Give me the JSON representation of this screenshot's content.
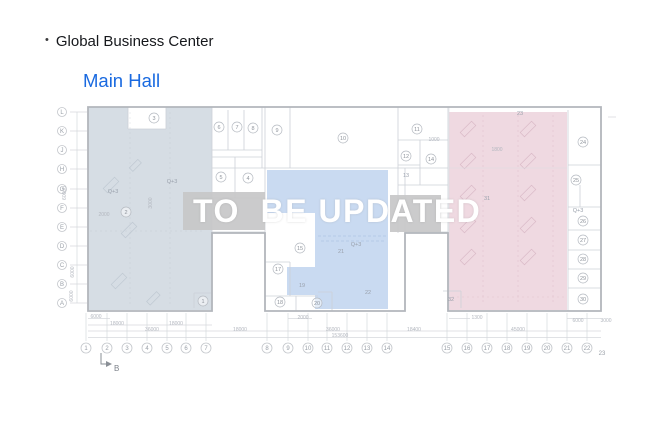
{
  "header": {
    "bullet": "•",
    "title": "Global Business Center",
    "subtitle": "Main Hall"
  },
  "overlay": {
    "text": "TO  BE UPDATED"
  },
  "colors": {
    "accent_blue": "#1a6ae0",
    "title_text": "#16181c",
    "overlay_text": "#ffffff",
    "left_region": "#cdd6de",
    "middle_region": "#c0d4ef",
    "right_region": "#ebd0da",
    "gray_block": "#c7c7c8"
  },
  "grid": {
    "letters": [
      "L",
      "K",
      "J",
      "H",
      "G",
      "F",
      "E",
      "D",
      "C",
      "B",
      "A"
    ],
    "letter_ys": [
      112,
      131,
      150,
      169,
      189,
      208,
      227,
      246,
      265,
      284,
      303
    ],
    "numbers": [
      {
        "t": "1",
        "x": 86
      },
      {
        "t": "2",
        "x": 107
      },
      {
        "t": "3",
        "x": 127
      },
      {
        "t": "4",
        "x": 147
      },
      {
        "t": "5",
        "x": 167
      },
      {
        "t": "6",
        "x": 186
      },
      {
        "t": "7",
        "x": 206
      },
      {
        "t": "8",
        "x": 267
      },
      {
        "t": "9",
        "x": 288
      },
      {
        "t": "10",
        "x": 308
      },
      {
        "t": "11",
        "x": 327
      },
      {
        "t": "12",
        "x": 347
      },
      {
        "t": "13",
        "x": 367
      },
      {
        "t": "14",
        "x": 387
      },
      {
        "t": "15",
        "x": 447
      },
      {
        "t": "16",
        "x": 467
      },
      {
        "t": "17",
        "x": 487
      },
      {
        "t": "18",
        "x": 507
      },
      {
        "t": "19",
        "x": 527
      },
      {
        "t": "20",
        "x": 547
      },
      {
        "t": "21",
        "x": 567
      },
      {
        "t": "22",
        "x": 587
      },
      {
        "t": "23",
        "x": 602,
        "nc": true
      }
    ],
    "section_marker": "B"
  },
  "rooms": [
    {
      "n": "3",
      "x": 154,
      "y": 118
    },
    {
      "n": "6",
      "x": 219,
      "y": 127
    },
    {
      "n": "7",
      "x": 237,
      "y": 127
    },
    {
      "n": "8",
      "x": 253,
      "y": 128
    },
    {
      "n": "9",
      "x": 277,
      "y": 130
    },
    {
      "n": "10",
      "x": 343,
      "y": 138
    },
    {
      "n": "11",
      "x": 417,
      "y": 129
    },
    {
      "n": "12",
      "x": 406,
      "y": 156
    },
    {
      "n": "14",
      "x": 431,
      "y": 159
    },
    {
      "n": "5",
      "x": 221,
      "y": 177
    },
    {
      "n": "4",
      "x": 248,
      "y": 178
    },
    {
      "n": "2",
      "x": 126,
      "y": 212
    },
    {
      "n": "1",
      "x": 203,
      "y": 301
    },
    {
      "n": "15",
      "x": 300,
      "y": 248
    },
    {
      "n": "17",
      "x": 278,
      "y": 269
    },
    {
      "n": "18",
      "x": 280,
      "y": 302
    },
    {
      "n": "20",
      "x": 317,
      "y": 303
    },
    {
      "n": "24",
      "x": 583,
      "y": 142
    },
    {
      "n": "25",
      "x": 576,
      "y": 180
    },
    {
      "n": "26",
      "x": 583,
      "y": 221
    },
    {
      "n": "27",
      "x": 583,
      "y": 240
    },
    {
      "n": "28",
      "x": 583,
      "y": 259
    },
    {
      "n": "29",
      "x": 583,
      "y": 278
    },
    {
      "n": "30",
      "x": 583,
      "y": 299
    }
  ],
  "labels": [
    {
      "t": "13",
      "x": 406,
      "y": 177
    },
    {
      "t": "19",
      "x": 302,
      "y": 287
    },
    {
      "t": "21",
      "x": 341,
      "y": 253
    },
    {
      "t": "22",
      "x": 368,
      "y": 294
    },
    {
      "t": "23",
      "x": 520,
      "y": 115
    },
    {
      "t": "31",
      "x": 487,
      "y": 200
    },
    {
      "t": "32",
      "x": 451,
      "y": 301
    },
    {
      "t": "Q+3",
      "x": 172,
      "y": 183
    },
    {
      "t": "Q+3",
      "x": 113,
      "y": 193
    },
    {
      "t": "Q+3",
      "x": 356,
      "y": 246
    },
    {
      "t": "Q+3",
      "x": 578,
      "y": 212
    }
  ],
  "dimensions": [
    {
      "t": "6000",
      "x": 96,
      "y": 318
    },
    {
      "t": "2000",
      "x": 303,
      "y": 319
    },
    {
      "t": "1300",
      "x": 477,
      "y": 319
    },
    {
      "t": "6000",
      "x": 578,
      "y": 322
    },
    {
      "t": "3000",
      "x": 606,
      "y": 322
    },
    {
      "t": "18000",
      "x": 117,
      "y": 325
    },
    {
      "t": "18000",
      "x": 176,
      "y": 325
    },
    {
      "t": "36000",
      "x": 152,
      "y": 331
    },
    {
      "t": "18000",
      "x": 240,
      "y": 331
    },
    {
      "t": "36000",
      "x": 333,
      "y": 331
    },
    {
      "t": "18400",
      "x": 414,
      "y": 331
    },
    {
      "t": "45000",
      "x": 518,
      "y": 331
    },
    {
      "t": "153600",
      "x": 340,
      "y": 337
    },
    {
      "t": "1000",
      "x": 434,
      "y": 141
    },
    {
      "t": "1800",
      "x": 497,
      "y": 151
    },
    {
      "t": "2000",
      "x": 104,
      "y": 216
    },
    {
      "t": "3000",
      "x": 152,
      "y": 203,
      "r": true
    },
    {
      "t": "60000",
      "x": 66,
      "y": 193,
      "r": true
    },
    {
      "t": "6000",
      "x": 74,
      "y": 272,
      "r": true
    },
    {
      "t": "6000",
      "x": 73,
      "y": 296,
      "r": true
    }
  ]
}
